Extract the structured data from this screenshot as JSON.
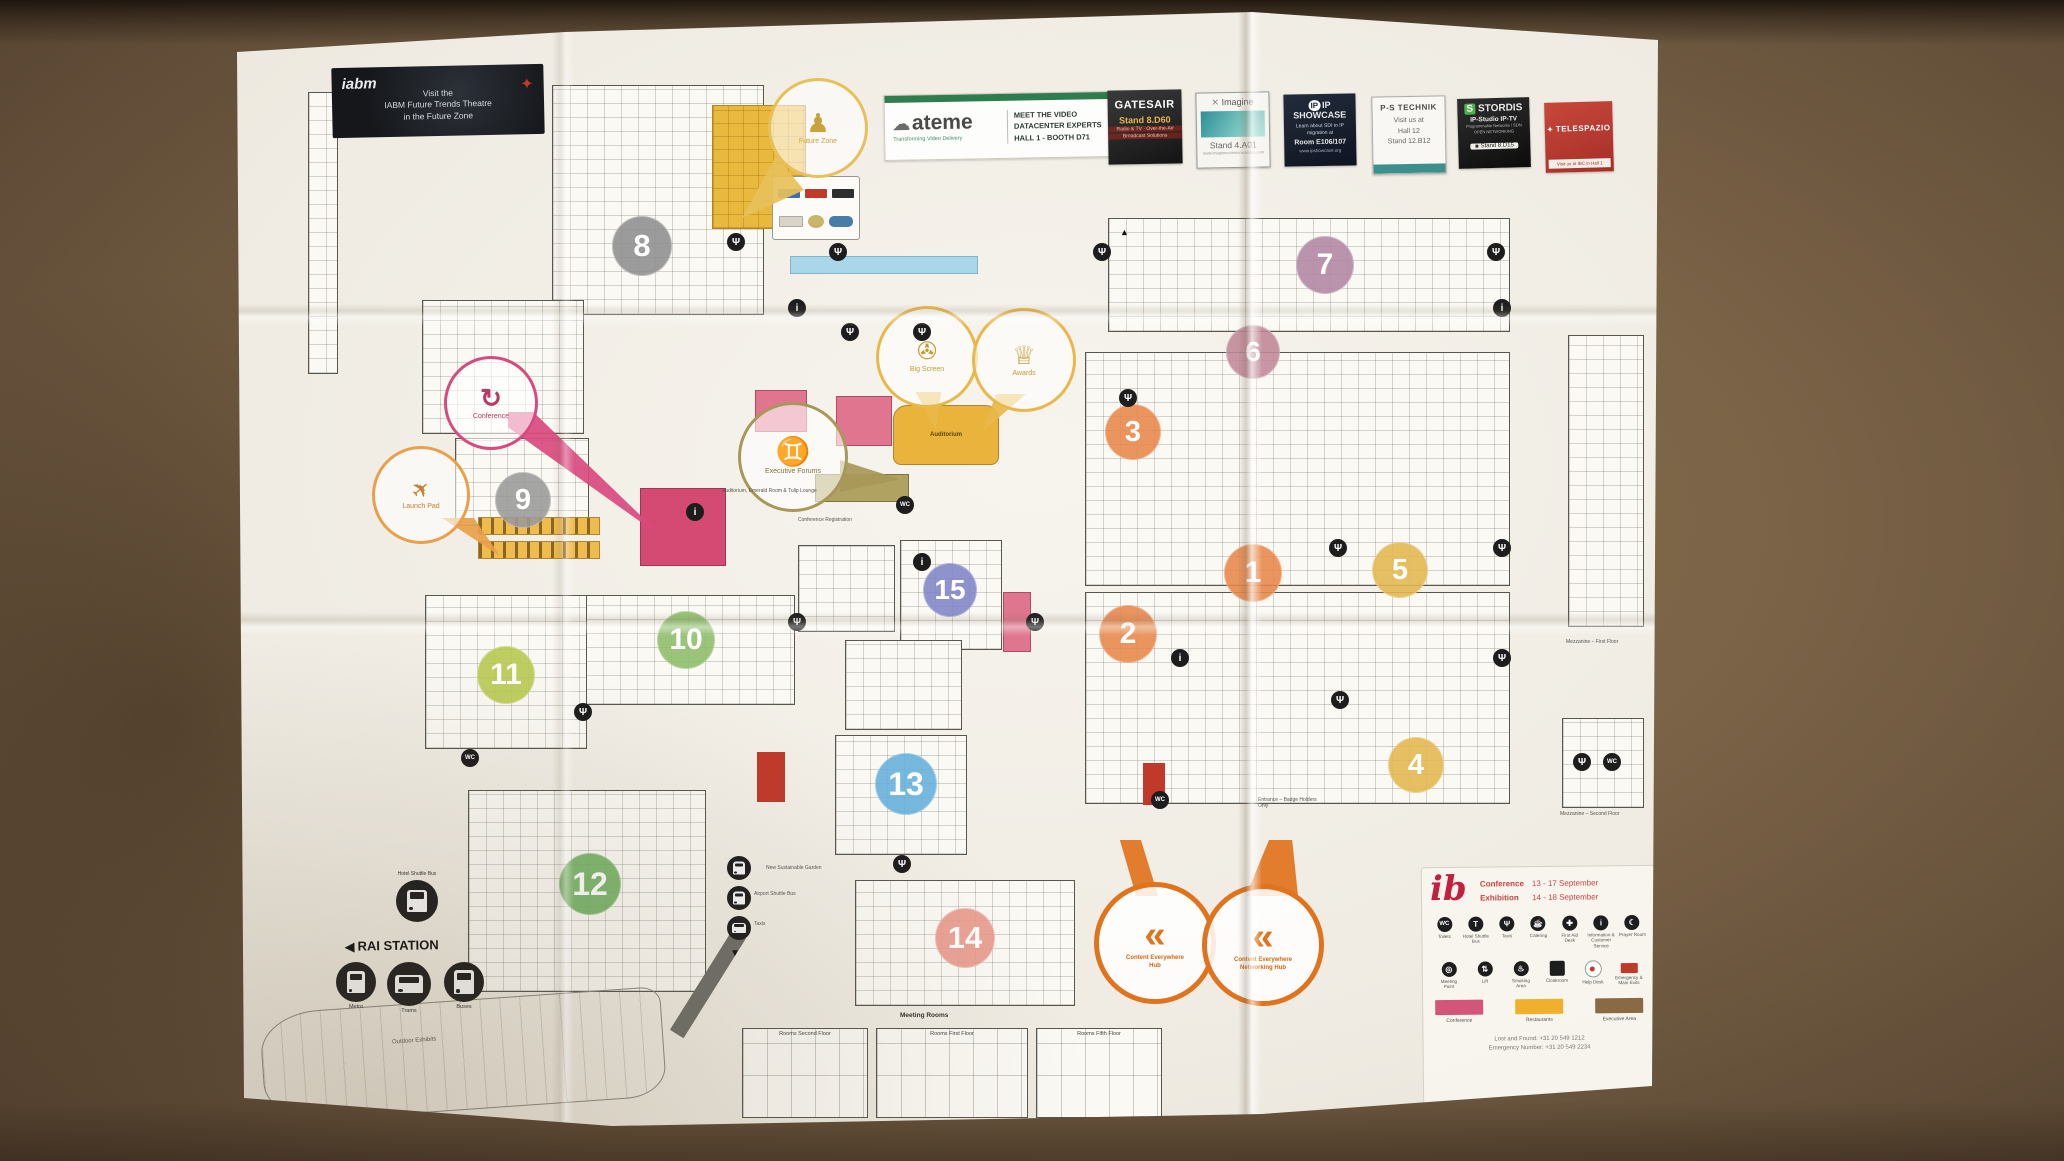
{
  "banners": {
    "iabm": {
      "logo_text": "iabm",
      "lines": [
        "Visit the",
        "IABM Future Trends Theatre",
        "in the Future Zone"
      ]
    },
    "ateme": {
      "logo_text": "ateme",
      "tagline": "Transforming Video Delivery",
      "lines": [
        "MEET THE VIDEO",
        "DATACENTER EXPERTS",
        "HALL 1 - BOOTH D71"
      ]
    },
    "sponsors": [
      {
        "name": "GATESAIR",
        "stand": "Stand 8.D60",
        "lines": [
          "Radio & TV · Over-the-Air",
          "Broadcast Solutions"
        ]
      },
      {
        "name": "Imagine",
        "stand": "Stand 4.A01",
        "lines": [
          "www.imaginecommunications.com"
        ]
      },
      {
        "name": "IP SHOWCASE",
        "stand": "Room E106/107",
        "lines": [
          "Learn about SDI to IP",
          "migration at",
          "www.ipshowcase.org"
        ]
      },
      {
        "name": "P-S TECHNIK",
        "stand": "Stand 12.B12",
        "lines": [
          "Visit us at",
          "Hall 12"
        ]
      },
      {
        "name": "STORDIS",
        "stand": "Stand 8.D15",
        "lines": [
          "IP-Studio  IP-TV",
          "Programmable Networks / SDN",
          "OPEN NETWORKING"
        ]
      },
      {
        "name": "TELESPAZIO",
        "stand": "",
        "lines": [
          "Visit us at IBC in Hall 1"
        ]
      }
    ]
  },
  "halls": [
    {
      "num": "1",
      "color": "#e8874a",
      "x": 1253,
      "y": 573,
      "d": 58
    },
    {
      "num": "2",
      "color": "#e8874a",
      "x": 1128,
      "y": 634,
      "d": 58
    },
    {
      "num": "3",
      "color": "#e8874a",
      "x": 1133,
      "y": 432,
      "d": 56
    },
    {
      "num": "4",
      "color": "#e3b84e",
      "x": 1416,
      "y": 765,
      "d": 56
    },
    {
      "num": "5",
      "color": "#e3b84e",
      "x": 1400,
      "y": 570,
      "d": 56
    },
    {
      "num": "6",
      "color": "#c08898",
      "x": 1253,
      "y": 352,
      "d": 54
    },
    {
      "num": "7",
      "color": "#b287a3",
      "x": 1325,
      "y": 265,
      "d": 58
    },
    {
      "num": "8",
      "color": "#8f8f8f",
      "x": 642,
      "y": 246,
      "d": 60
    },
    {
      "num": "9",
      "color": "#9a9a9a",
      "x": 523,
      "y": 500,
      "d": 56
    },
    {
      "num": "10",
      "color": "#8cbd6a",
      "x": 686,
      "y": 640,
      "d": 58
    },
    {
      "num": "11",
      "color": "#b7c94e",
      "x": 506,
      "y": 675,
      "d": 58
    },
    {
      "num": "12",
      "color": "#6faf5e",
      "x": 590,
      "y": 884,
      "d": 62
    },
    {
      "num": "13",
      "color": "#64b0dc",
      "x": 906,
      "y": 784,
      "d": 62
    },
    {
      "num": "14",
      "color": "#e8988a",
      "x": 965,
      "y": 938,
      "d": 60
    },
    {
      "num": "15",
      "color": "#7f85c8",
      "x": 950,
      "y": 590,
      "d": 54
    }
  ],
  "callouts": {
    "future_zone": {
      "label": "Future Zone"
    },
    "conference": {
      "label": "Conference"
    },
    "launch_pad": {
      "label": "Launch Pad"
    },
    "executive_forums": {
      "label": "Executive Forums"
    },
    "big_screen": {
      "label": "Big Screen"
    },
    "awards": {
      "label": "Awards"
    },
    "hub1": {
      "label": "Content Everywhere",
      "label2": "Hub"
    },
    "hub2": {
      "label": "Content Everywhere",
      "label2": "Networking Hub"
    }
  },
  "map_labels": {
    "auditorium": "Auditorium",
    "lounge_strip": "Auditorium, Emerald Room & Tulip Lounge",
    "conference_registration": "Conference Registration",
    "outdoor_exhibits": "Outdoor Exhibits",
    "sustainable_garden": "New Sustainable Garden",
    "entrance_badge": "Entrance – Badge Holders Only",
    "mezzanine1": "Mezzanine – First Floor",
    "mezzanine2": "Mezzanine – Second Floor",
    "meeting_rooms_title": "Meeting Rooms",
    "rooms_groups": [
      "Rooms Second Floor",
      "Rooms First Floor",
      "Rooms Fifth Floor"
    ]
  },
  "station": {
    "title": "RAI STATION",
    "items": [
      "Metro",
      "Trams",
      "Buses"
    ],
    "shuttle": "Hotel Shuttle Bus",
    "extra": [
      "Hotel Shuttle Bus",
      "Airport Shuttle Bus",
      "Taxis"
    ]
  },
  "legend": {
    "rows_info": [
      {
        "label": "Conference",
        "dates": "13 - 17 September"
      },
      {
        "label": "Exhibition",
        "dates": "14 - 18 September"
      }
    ],
    "icons_row1": [
      "Toilets",
      "Hotel Shuttle Bus",
      "Taxis",
      "Catering",
      "First Aid Desk",
      "Information & Customer Service",
      "Prayer Room"
    ],
    "icons_row2": [
      "Meeting Point",
      "Lift",
      "Smoking Area",
      "Cloakroom",
      "Help Desk",
      "Emergency & Main Exits"
    ],
    "swatches": [
      {
        "label": "Conference",
        "color": "#d4557a"
      },
      {
        "label": "Restaurants",
        "color": "#f0b02e"
      },
      {
        "label": "Executive Area",
        "color": "#8a6a45"
      }
    ],
    "phones": [
      "Lost and Found: +31 20 549 1212",
      "Emergency Number: +31 20 549 2234"
    ]
  }
}
